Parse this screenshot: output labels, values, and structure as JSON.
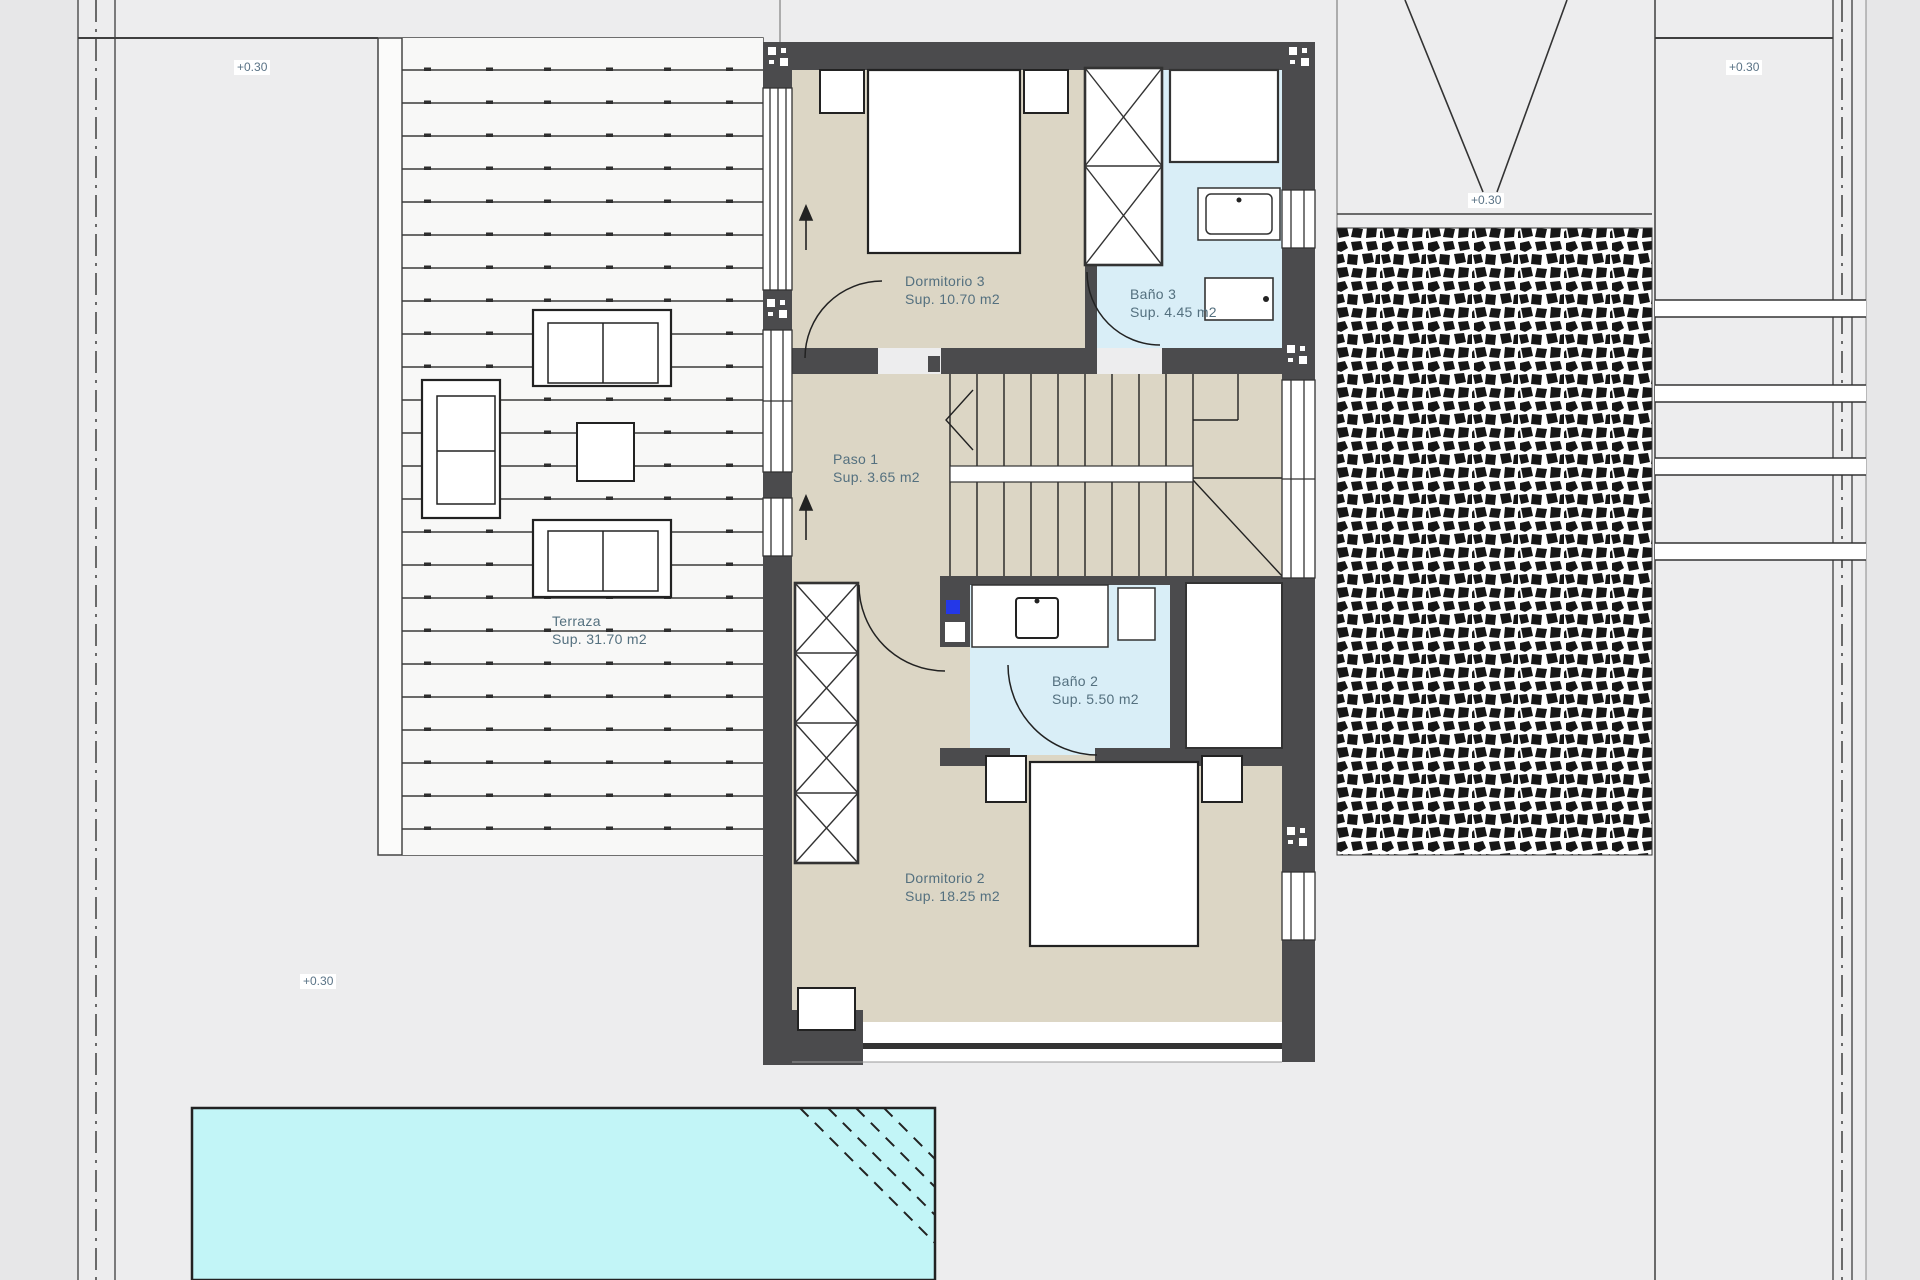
{
  "drawing": {
    "type": "architectural-floor-plan",
    "rooms": [
      {
        "id": "dormitorio-3",
        "name": "Dormitorio 3",
        "area": "Sup. 10.70 m2"
      },
      {
        "id": "bano-3",
        "name": "Baño 3",
        "area": "Sup. 4.45 m2"
      },
      {
        "id": "paso-1",
        "name": "Paso 1",
        "area": "Sup. 3.65 m2"
      },
      {
        "id": "terraza",
        "name": "Terraza",
        "area": "Sup. 31.70 m2"
      },
      {
        "id": "bano-2",
        "name": "Baño 2",
        "area": "Sup. 5.50 m2"
      },
      {
        "id": "dormitorio-2",
        "name": "Dormitorio 2",
        "area": "Sup. 18.25 m2"
      }
    ],
    "elevation_markers": [
      {
        "label": "+0.30"
      },
      {
        "label": "+0.30"
      },
      {
        "label": "+0.30"
      },
      {
        "label": "+0.30"
      }
    ],
    "colors": {
      "wall": "#4b4b4d",
      "floor_beige": "#dcd6c5",
      "bath_blue": "#d9eef7",
      "pool_cyan": "#c2f5f7",
      "label_text": "#54707f",
      "utility_blue": "#2438e8"
    }
  }
}
